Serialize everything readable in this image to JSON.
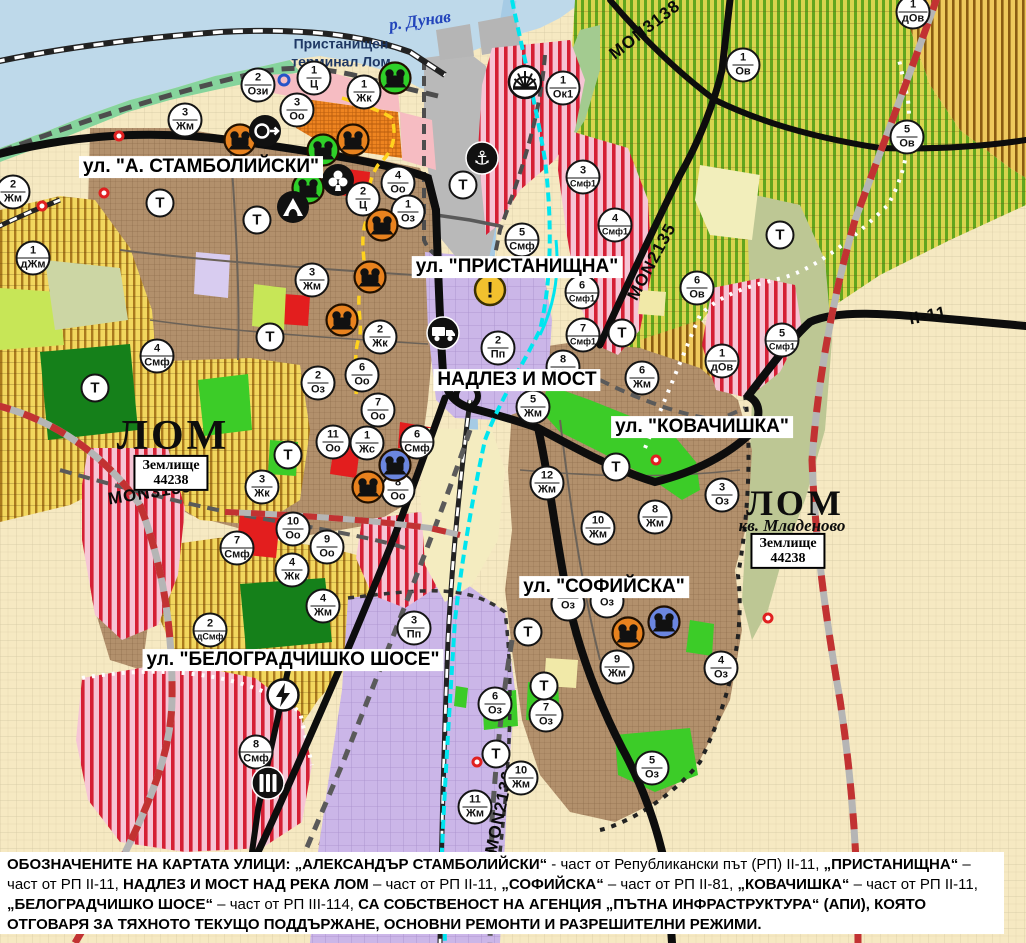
{
  "map": {
    "river_label": "р. Дунав",
    "terminal_label_line1": "Пристанищен",
    "terminal_label_line2": "терминал Лом",
    "street_labels": [
      {
        "text": "ул. \"А. СТАМБОЛИЙСКИ\"",
        "x": 201,
        "y": 167
      },
      {
        "text": "ул. \"ПРИСТАНИЩНА\"",
        "x": 517,
        "y": 267
      },
      {
        "text": "НАДЛЕЗ И МОСТ",
        "x": 517,
        "y": 380
      },
      {
        "text": "ул. \"КОВАЧИШКА\"",
        "x": 702,
        "y": 427
      },
      {
        "text": "ул. \"СОФИЙСКА\"",
        "x": 604,
        "y": 587
      },
      {
        "text": "ул. \"БЕЛОГРАДЧИШКО ШОСЕ\"",
        "x": 293,
        "y": 660
      }
    ],
    "road_labels": [
      {
        "text": "MON3138",
        "x": 645,
        "y": 30,
        "rot": -38
      },
      {
        "text": "MON2135",
        "x": 652,
        "y": 262,
        "rot": -62
      },
      {
        "text": "MON3139",
        "x": 150,
        "y": 493,
        "rot": -9
      },
      {
        "text": "II-11",
        "x": 928,
        "y": 316,
        "rot": -11
      },
      {
        "text": "MON2136",
        "x": 500,
        "y": 812,
        "rot": -78
      }
    ],
    "place_labels": {
      "city_west": "ЛОМ",
      "city_east": "ЛОМ",
      "quarter_east": "кв. Младеново"
    },
    "land_plots": [
      {
        "line1": "Землище",
        "line2": "44238",
        "x": 171,
        "y": 473
      },
      {
        "line1": "Землище",
        "line2": "44238",
        "x": 788,
        "y": 551
      }
    ],
    "t_label": "Т",
    "zone_markers": [
      [
        258,
        85,
        "2",
        "Ози"
      ],
      [
        314,
        78,
        "1",
        "Ц"
      ],
      [
        364,
        92,
        "1",
        "Жк"
      ],
      [
        297,
        110,
        "3",
        "Оо"
      ],
      [
        185,
        120,
        "3",
        "Жм"
      ],
      [
        563,
        88,
        "1",
        "Ок1"
      ],
      [
        13,
        192,
        "2",
        "Жм"
      ],
      [
        398,
        183,
        "4",
        "Оо"
      ],
      [
        363,
        199,
        "2",
        "Ц"
      ],
      [
        408,
        212,
        "1",
        "Оз"
      ],
      [
        33,
        258,
        "1",
        "дЖм"
      ],
      [
        583,
        177,
        "3",
        "Смф1"
      ],
      [
        615,
        225,
        "4",
        "Смф1"
      ],
      [
        522,
        240,
        "5",
        "Смф"
      ],
      [
        582,
        292,
        "6",
        "Смф1"
      ],
      [
        583,
        335,
        "7",
        "Смф1"
      ],
      [
        697,
        288,
        "6",
        "Ов"
      ],
      [
        782,
        340,
        "5",
        "Смф1"
      ],
      [
        722,
        361,
        "1",
        "дОв"
      ],
      [
        913,
        12,
        "1",
        "дОв"
      ],
      [
        743,
        65,
        "1",
        "Ов"
      ],
      [
        907,
        137,
        "5",
        "Ов"
      ],
      [
        312,
        280,
        "3",
        "Жм"
      ],
      [
        380,
        337,
        "2",
        "Жк"
      ],
      [
        318,
        383,
        "2",
        "Оз"
      ],
      [
        362,
        375,
        "6",
        "Оо"
      ],
      [
        378,
        410,
        "7",
        "Оо"
      ],
      [
        333,
        442,
        "11",
        "Оо"
      ],
      [
        367,
        443,
        "1",
        "Жс"
      ],
      [
        417,
        442,
        "6",
        "Смф"
      ],
      [
        398,
        490,
        "8",
        "Оо"
      ],
      [
        262,
        487,
        "3",
        "Жк"
      ],
      [
        157,
        356,
        "4",
        "Смф"
      ],
      [
        498,
        348,
        "2",
        "Пп"
      ],
      [
        563,
        367,
        "8",
        "Жм"
      ],
      [
        533,
        407,
        "5",
        "Жм"
      ],
      [
        642,
        378,
        "6",
        "Жм"
      ],
      [
        547,
        483,
        "12",
        "Жм"
      ],
      [
        598,
        528,
        "10",
        "Жм"
      ],
      [
        655,
        517,
        "8",
        "Жм"
      ],
      [
        722,
        495,
        "3",
        "Оз"
      ],
      [
        293,
        529,
        "10",
        "Оо"
      ],
      [
        327,
        547,
        "9",
        "Оо"
      ],
      [
        292,
        570,
        "4",
        "Жк"
      ],
      [
        323,
        606,
        "4",
        "Жм"
      ],
      [
        237,
        548,
        "7",
        "Смф"
      ],
      [
        414,
        628,
        "3",
        "Пп"
      ],
      [
        210,
        630,
        "2",
        "дСмф"
      ],
      [
        256,
        752,
        "8",
        "Смф"
      ],
      [
        495,
        704,
        "6",
        "Оз"
      ],
      [
        546,
        715,
        "7",
        "Оз"
      ],
      [
        521,
        778,
        "10",
        "Жм"
      ],
      [
        475,
        807,
        "11",
        "Жм"
      ],
      [
        652,
        768,
        "5",
        "Оз"
      ],
      [
        617,
        667,
        "9",
        "Жм"
      ],
      [
        721,
        668,
        "4",
        "Оз"
      ],
      [
        568,
        604,
        "",
        "Оз"
      ],
      [
        607,
        601,
        "",
        "Оз"
      ]
    ],
    "t_markers": [
      [
        160,
        203
      ],
      [
        257,
        220
      ],
      [
        463,
        185
      ],
      [
        270,
        337
      ],
      [
        95,
        388
      ],
      [
        288,
        455
      ],
      [
        622,
        333
      ],
      [
        780,
        235
      ],
      [
        616,
        467
      ],
      [
        528,
        632
      ],
      [
        544,
        686
      ],
      [
        496,
        754
      ]
    ],
    "icon_markers": [
      [
        "anchor-icon",
        482,
        158
      ],
      [
        "port-fan-icon",
        525,
        82
      ],
      [
        "culture-green",
        395,
        78
      ],
      [
        "culture-green",
        323,
        150
      ],
      [
        "culture-green",
        308,
        188
      ],
      [
        "culture-orange",
        240,
        140
      ],
      [
        "culture-orange",
        353,
        140
      ],
      [
        "culture-orange",
        370,
        277
      ],
      [
        "culture-orange",
        342,
        320
      ],
      [
        "culture-orange",
        382,
        225
      ],
      [
        "culture-orange",
        368,
        487
      ],
      [
        "culture-orange",
        628,
        633
      ],
      [
        "culture-blue",
        395,
        465
      ],
      [
        "culture-blue",
        664,
        622
      ],
      [
        "ring-arrow-icon",
        265,
        131
      ],
      [
        "club-icon",
        338,
        180
      ],
      [
        "tunnel-icon",
        293,
        207
      ],
      [
        "warning-icon",
        490,
        290
      ],
      [
        "truck-icon",
        443,
        333
      ],
      [
        "power-icon",
        283,
        695
      ],
      [
        "station-icon",
        268,
        783
      ]
    ],
    "point_markers": [
      [
        119,
        136
      ],
      [
        104,
        193
      ],
      [
        42,
        206
      ],
      [
        656,
        460
      ],
      [
        477,
        762
      ],
      [
        768,
        618
      ]
    ],
    "ring_markers": [
      [
        284,
        80
      ]
    ],
    "colors": {
      "culture_orange": "#e8821e",
      "culture_blue": "#6b86e0",
      "culture_green": "#2fd029",
      "warning_yellow": "#f2c12e",
      "marker_border": "#141414",
      "water": "#bed9ea",
      "boundary_red": "#c23232",
      "canal_cyan": "#00e5ef",
      "historic_yellow": "#ffd21e"
    }
  },
  "footer": {
    "segments": [
      {
        "t": "ОБОЗНАЧЕНИТЕ НА КАРТАТА УЛИЦИ: „АЛЕКСАНДЪР СТАМБОЛИЙСКИ“",
        "b": true
      },
      {
        "t": " - част от Републикански път (РП) II-11, ",
        "b": false
      },
      {
        "t": "„ПРИСТАНИЩНА“",
        "b": true
      },
      {
        "t": " – част от РП II-11, ",
        "b": false
      },
      {
        "t": "НАДЛЕЗ И МОСТ НАД РЕКА ЛОМ",
        "b": true
      },
      {
        "t": " – част от РП II-11, ",
        "b": false
      },
      {
        "t": "„СОФИЙСКА“",
        "b": true
      },
      {
        "t": " – част от РП II-81, ",
        "b": false
      },
      {
        "t": "„КОВАЧИШКА“",
        "b": true
      },
      {
        "t": " – част от РП II-11, ",
        "b": false
      },
      {
        "t": "„БЕЛОГРАДЧИШКО ШОСЕ“",
        "b": true
      },
      {
        "t": " – част от РП III-114, ",
        "b": false
      },
      {
        "t": "СА СОБСТВЕНОСТ НА АГЕНЦИЯ „ПЪТНА ИНФРАСТРУКТУРА“ (АПИ), КОЯТО ОТГОВАРЯ ЗА ТЯХНОТО ТЕКУЩО ПОДДЪРЖАНЕ, ОСНОВНИ РЕМОНТИ И РАЗРЕШИТЕЛНИ РЕЖИМИ.",
        "b": true
      }
    ]
  }
}
